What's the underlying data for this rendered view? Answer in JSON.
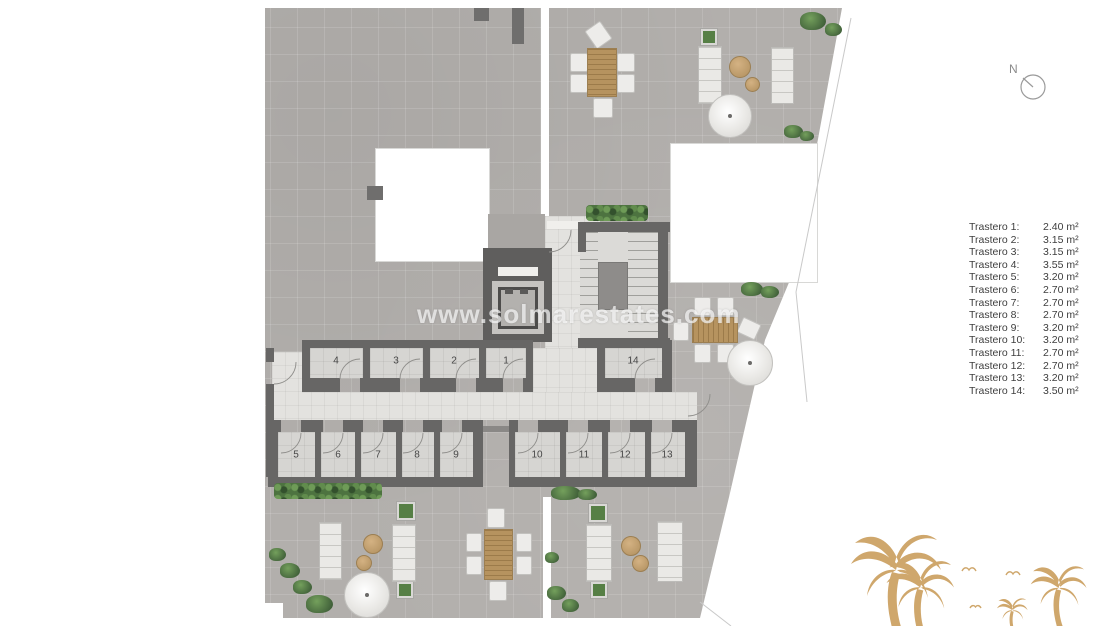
{
  "watermark": "www.solmarestates.com",
  "compass": {
    "label": "N"
  },
  "legend": {
    "items": [
      {
        "label": "Trastero 1:",
        "area": "2.40 m²"
      },
      {
        "label": "Trastero 2:",
        "area": "3.15 m²"
      },
      {
        "label": "Trastero 3:",
        "area": "3.15 m²"
      },
      {
        "label": "Trastero 4:",
        "area": "3.55 m²"
      },
      {
        "label": "Trastero 5:",
        "area": "3.20 m²"
      },
      {
        "label": "Trastero 6:",
        "area": "2.70 m²"
      },
      {
        "label": "Trastero 7:",
        "area": "2.70 m²"
      },
      {
        "label": "Trastero 8:",
        "area": "2.70 m²"
      },
      {
        "label": "Trastero 9:",
        "area": "3.20 m²"
      },
      {
        "label": "Trastero 10:",
        "area": "3.20 m²"
      },
      {
        "label": "Trastero 11:",
        "area": "2.70 m²"
      },
      {
        "label": "Trastero 12:",
        "area": "2.70 m²"
      },
      {
        "label": "Trastero 13:",
        "area": "3.20 m²"
      },
      {
        "label": "Trastero 14:",
        "area": "3.50 m²"
      }
    ]
  },
  "plan": {
    "rooms": [
      {
        "number": "1"
      },
      {
        "number": "2"
      },
      {
        "number": "3"
      },
      {
        "number": "4"
      },
      {
        "number": "5"
      },
      {
        "number": "6"
      },
      {
        "number": "7"
      },
      {
        "number": "8"
      },
      {
        "number": "9"
      },
      {
        "number": "10"
      },
      {
        "number": "11"
      },
      {
        "number": "12"
      },
      {
        "number": "13"
      },
      {
        "number": "14"
      }
    ],
    "colors": {
      "terrace": "#b2afac",
      "wall": "#676665",
      "corridor": "#e3e2df",
      "room_floor": "#d6d5d2",
      "greenery": "#527a42",
      "wood": "#b6935f",
      "palm": "#cfa76c"
    }
  }
}
